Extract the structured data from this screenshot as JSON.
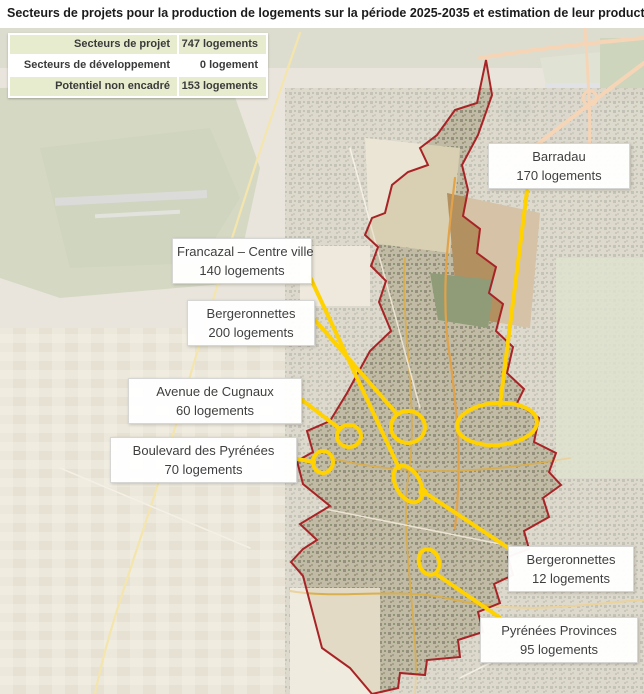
{
  "title": "Secteurs de projets pour la production de logements sur la période 2025-2035 et estimation de leur production",
  "legend": {
    "rows": [
      {
        "label": "Secteurs de projet",
        "value": "747 logements"
      },
      {
        "label": "Secteurs de développement futur",
        "value": "0 logement"
      },
      {
        "label": "Potentiel non encadré",
        "value": "153 logements"
      }
    ]
  },
  "map": {
    "labels": [
      {
        "id": "barradau",
        "name": "Barradau",
        "count": "170 logements"
      },
      {
        "id": "francazal-centre-ville",
        "name": "Francazal – Centre ville",
        "count": "140 logements"
      },
      {
        "id": "bergeronnettes-200",
        "name": "Bergeronnettes",
        "count": "200 logements"
      },
      {
        "id": "avenue-de-cugnaux",
        "name": "Avenue de Cugnaux",
        "count": "60 logements"
      },
      {
        "id": "boulevard-des-pyrenees",
        "name": "Boulevard des Pyrénées",
        "count": "70 logements"
      },
      {
        "id": "bergeronnettes-12",
        "name": "Bergeronnettes",
        "count": "12 logements"
      },
      {
        "id": "pyrenees-provinces",
        "name": "Pyrénées Provinces",
        "count": "95 logements"
      }
    ]
  },
  "colors": {
    "annotation_yellow": "#FFD200",
    "boundary_red": "#A82326",
    "legend_green": "#E8ECCE",
    "label_text": "#3F3F3F"
  }
}
